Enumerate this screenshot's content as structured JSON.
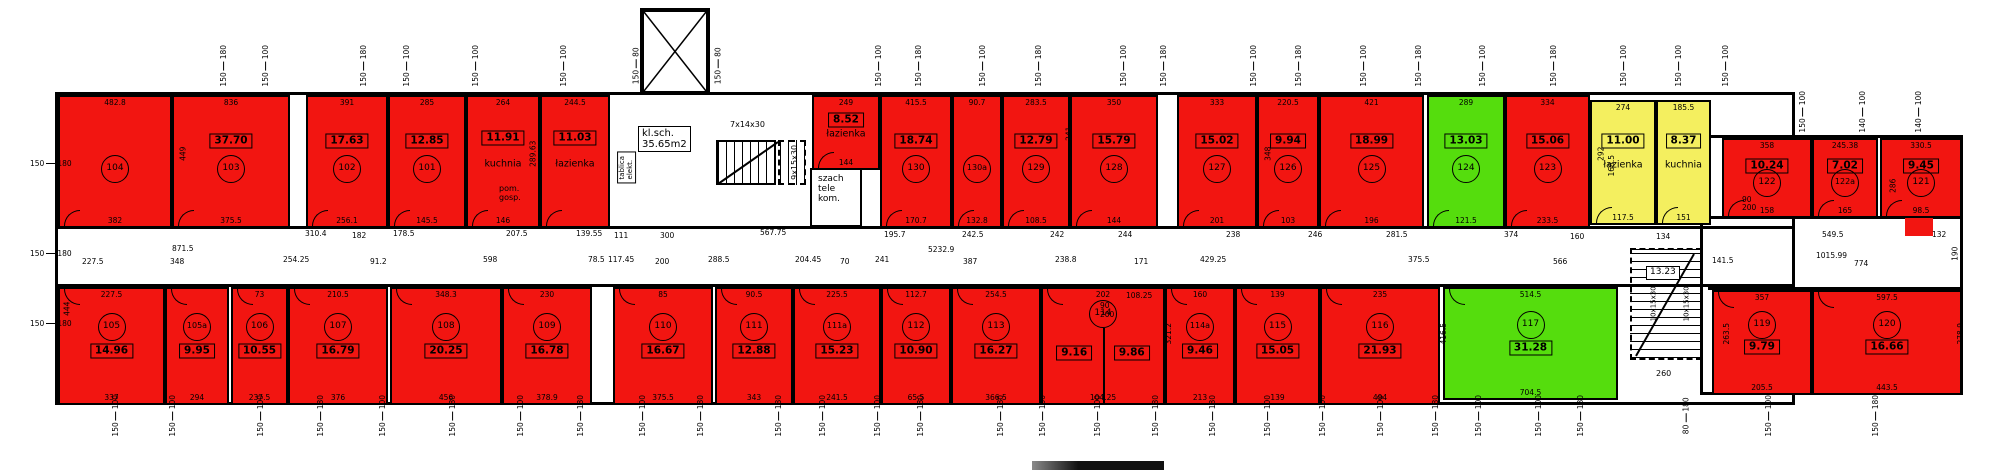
{
  "plan": {
    "colors": {
      "red": "#f21511",
      "green": "#55dd0d",
      "yellow": "#f4ef5f",
      "wall": "#000000"
    },
    "stair_hall_label": [
      "kl.sch.",
      "35.65m2"
    ],
    "rooms": [
      {
        "x": 58,
        "y": 95,
        "w": 114,
        "h": 133,
        "c": "red",
        "row": "top",
        "id": "104",
        "dimTop": "482.8",
        "dimBot": "382"
      },
      {
        "x": 172,
        "y": 95,
        "w": 118,
        "h": 133,
        "c": "red",
        "row": "top",
        "id": "103",
        "area": "37.70",
        "dimTop": "836",
        "dimBot": "375.5"
      },
      {
        "x": 306,
        "y": 95,
        "w": 82,
        "h": 133,
        "c": "red",
        "row": "top",
        "id": "102",
        "area": "17.63",
        "dimTop": "391",
        "dimBot": "256.1"
      },
      {
        "x": 388,
        "y": 95,
        "w": 78,
        "h": 133,
        "c": "red",
        "row": "top",
        "id": "101",
        "area": "12.85",
        "dimTop": "285",
        "dimBot": "145.5"
      },
      {
        "x": 466,
        "y": 95,
        "w": 74,
        "h": 133,
        "c": "red",
        "row": "top",
        "name": "kuchnia",
        "area": "11.91",
        "dimTop": "264",
        "dimBot": "146"
      },
      {
        "x": 540,
        "y": 95,
        "w": 70,
        "h": 133,
        "c": "red",
        "row": "top",
        "name": "łazienka",
        "area": "11.03",
        "dimTop": "244.5"
      },
      {
        "x": 812,
        "y": 95,
        "w": 68,
        "h": 75,
        "c": "red",
        "row": "top",
        "name": "łazienka",
        "area": "8.52",
        "dimTop": "249",
        "dimBot": "144"
      },
      {
        "x": 880,
        "y": 95,
        "w": 72,
        "h": 133,
        "c": "red",
        "row": "top",
        "id": "130",
        "area": "18.74",
        "dimTop": "415.5",
        "dimBot": "170.7"
      },
      {
        "x": 952,
        "y": 95,
        "w": 50,
        "h": 133,
        "c": "red",
        "row": "top",
        "id": "130a",
        "dimTop": "90.7",
        "dimBot": "132.8"
      },
      {
        "x": 1002,
        "y": 95,
        "w": 68,
        "h": 133,
        "c": "red",
        "row": "top",
        "id": "129",
        "area": "12.79",
        "dimTop": "283.5",
        "dimBot": "108.5"
      },
      {
        "x": 1070,
        "y": 95,
        "w": 88,
        "h": 133,
        "c": "red",
        "row": "top",
        "id": "128",
        "area": "15.79",
        "dimTop": "350",
        "dimBot": "144"
      },
      {
        "x": 1177,
        "y": 95,
        "w": 80,
        "h": 133,
        "c": "red",
        "row": "top",
        "id": "127",
        "area": "15.02",
        "dimTop": "333",
        "dimBot": "201"
      },
      {
        "x": 1257,
        "y": 95,
        "w": 62,
        "h": 133,
        "c": "red",
        "row": "top",
        "id": "126",
        "area": "9.94",
        "dimTop": "220.5",
        "dimBot": "103"
      },
      {
        "x": 1319,
        "y": 95,
        "w": 105,
        "h": 133,
        "c": "red",
        "row": "top",
        "id": "125",
        "area": "18.99",
        "dimTop": "421",
        "dimBot": "196"
      },
      {
        "x": 1427,
        "y": 95,
        "w": 78,
        "h": 133,
        "c": "green",
        "row": "top",
        "id": "124",
        "area": "13.03",
        "dimTop": "289",
        "dimBot": "121.5"
      },
      {
        "x": 1505,
        "y": 95,
        "w": 85,
        "h": 133,
        "c": "red",
        "row": "top",
        "id": "123",
        "area": "15.06",
        "dimTop": "334",
        "dimBot": "233.5"
      },
      {
        "x": 1590,
        "y": 100,
        "w": 66,
        "h": 125,
        "c": "yellow",
        "row": "top",
        "name": "łazienka",
        "area": "11.00",
        "dimTop": "274",
        "dimBot": "117.5"
      },
      {
        "x": 1656,
        "y": 100,
        "w": 55,
        "h": 125,
        "c": "yellow",
        "row": "top",
        "name": "kuchnia",
        "area": "8.37",
        "dimTop": "185.5",
        "dimBot": "151"
      },
      {
        "x": 1722,
        "y": 138,
        "w": 90,
        "h": 80,
        "c": "red",
        "row": "top",
        "id": "122",
        "area": "10.24",
        "dimTop": "358",
        "dimBot": "158"
      },
      {
        "x": 1812,
        "y": 138,
        "w": 66,
        "h": 80,
        "c": "red",
        "row": "top",
        "id": "122a",
        "area": "7.02",
        "dimTop": "245.38",
        "dimBot": "165"
      },
      {
        "x": 1880,
        "y": 138,
        "w": 82,
        "h": 80,
        "c": "red",
        "row": "top",
        "id": "121",
        "area": "9.45",
        "dimTop": "330.5",
        "dimBot": "98.5"
      },
      {
        "x": 58,
        "y": 287,
        "w": 107,
        "h": 118,
        "c": "red",
        "row": "bottom",
        "id": "105",
        "area": "14.96",
        "dimTop": "227.5",
        "dimBot": "337"
      },
      {
        "x": 165,
        "y": 287,
        "w": 64,
        "h": 118,
        "c": "red",
        "row": "bottom",
        "id": "105a",
        "area": "9.95",
        "dimBot": "294"
      },
      {
        "x": 231,
        "y": 287,
        "w": 57,
        "h": 118,
        "c": "red",
        "row": "bottom",
        "id": "106",
        "area": "10.55",
        "dimTop": "73",
        "dimBot": "237.5"
      },
      {
        "x": 288,
        "y": 287,
        "w": 100,
        "h": 118,
        "c": "red",
        "row": "bottom",
        "id": "107",
        "area": "16.79",
        "dimTop": "210.5",
        "dimBot": "376"
      },
      {
        "x": 390,
        "y": 287,
        "w": 112,
        "h": 118,
        "c": "red",
        "row": "bottom",
        "id": "108",
        "area": "20.25",
        "dimTop": "348.3",
        "dimBot": "456"
      },
      {
        "x": 502,
        "y": 287,
        "w": 90,
        "h": 118,
        "c": "red",
        "row": "bottom",
        "id": "109",
        "area": "16.78",
        "dimTop": "230",
        "dimBot": "378.9"
      },
      {
        "x": 613,
        "y": 287,
        "w": 100,
        "h": 118,
        "c": "red",
        "row": "bottom",
        "id": "110",
        "area": "16.67",
        "dimTop": "85",
        "dimBot": "375.5"
      },
      {
        "x": 715,
        "y": 287,
        "w": 78,
        "h": 118,
        "c": "red",
        "row": "bottom",
        "id": "111",
        "area": "12.88",
        "dimTop": "90.5",
        "dimBot": "343"
      },
      {
        "x": 793,
        "y": 287,
        "w": 88,
        "h": 118,
        "c": "red",
        "row": "bottom",
        "id": "111a",
        "area": "15.23",
        "dimTop": "225.5",
        "dimBot": "241.5"
      },
      {
        "x": 881,
        "y": 287,
        "w": 70,
        "h": 118,
        "c": "red",
        "row": "bottom",
        "id": "112",
        "area": "10.90",
        "dimTop": "112.7",
        "dimBot": "65.5"
      },
      {
        "x": 951,
        "y": 287,
        "w": 90,
        "h": 118,
        "c": "red",
        "row": "bottom",
        "id": "113",
        "area": "16.27",
        "dimTop": "254.5",
        "dimBot": "366.5"
      },
      {
        "x": 1041,
        "y": 287,
        "w": 124,
        "h": 118,
        "c": "red",
        "row": "bottom",
        "id": "114",
        "area": "9.16",
        "area2": "9.86",
        "dimTop": "202",
        "dimBot": "104.25"
      },
      {
        "x": 1165,
        "y": 287,
        "w": 70,
        "h": 118,
        "c": "red",
        "row": "bottom",
        "id": "114a",
        "area": "9.46",
        "dimTop": "160",
        "dimBot": "213"
      },
      {
        "x": 1235,
        "y": 287,
        "w": 85,
        "h": 118,
        "c": "red",
        "row": "bottom",
        "id": "115",
        "area": "15.05",
        "dimTop": "139",
        "dimBot": "139"
      },
      {
        "x": 1320,
        "y": 287,
        "w": 120,
        "h": 118,
        "c": "red",
        "row": "bottom",
        "id": "116",
        "area": "21.93",
        "dimTop": "235",
        "dimBot": "494"
      },
      {
        "x": 1443,
        "y": 287,
        "w": 175,
        "h": 113,
        "c": "green",
        "row": "bottom",
        "id": "117",
        "area": "31.28",
        "dimTop": "514.5",
        "dimBot": "704.5"
      },
      {
        "x": 1712,
        "y": 290,
        "w": 100,
        "h": 105,
        "c": "red",
        "row": "bottom",
        "id": "119",
        "area": "9.79",
        "dimTop": "357",
        "dimBot": "205.5"
      },
      {
        "x": 1812,
        "y": 290,
        "w": 150,
        "h": 105,
        "c": "red",
        "row": "bottom",
        "id": "120",
        "area": "16.66",
        "dimTop": "597.5",
        "dimBot": "443.5"
      }
    ],
    "labels": [
      {
        "lines": [
          "kl.sch.",
          "35.65m2"
        ],
        "x": 638,
        "y": 126,
        "bx": true,
        "size": 10
      },
      {
        "lines": [
          "7x14x30"
        ],
        "x": 730,
        "y": 121,
        "size": 8
      },
      {
        "lines": [
          "9x15x30"
        ],
        "x": 778,
        "y": 158,
        "v": true,
        "size": 8
      },
      {
        "lines": [
          "tablica",
          "elekt."
        ],
        "x": 611,
        "y": 158,
        "v": true,
        "size": 7,
        "bx": true
      },
      {
        "lines": [
          "szach",
          "tele",
          "kom."
        ],
        "x": 818,
        "y": 175,
        "size": 9
      },
      {
        "lines": [
          "pom.",
          "gosp."
        ],
        "x": 499,
        "y": 185,
        "size": 8
      },
      {
        "lines": [
          "13.23"
        ],
        "x": 1646,
        "y": 266,
        "bx": true,
        "size": 9
      },
      {
        "lines": [
          "10x15x30"
        ],
        "x": 1637,
        "y": 300,
        "v": true,
        "size": 7
      },
      {
        "lines": [
          "10x15x30"
        ],
        "x": 1670,
        "y": 300,
        "v": true,
        "size": 7
      },
      {
        "lines": [
          "260"
        ],
        "x": 1656,
        "y": 370,
        "size": 8
      }
    ],
    "dims": [
      {
        "t": "871.5",
        "x": 172,
        "y": 245
      },
      {
        "t": "227.5",
        "x": 82,
        "y": 258
      },
      {
        "t": "348",
        "x": 170,
        "y": 258
      },
      {
        "t": "254.25",
        "x": 283,
        "y": 256
      },
      {
        "t": "91.2",
        "x": 370,
        "y": 258
      },
      {
        "t": "598",
        "x": 483,
        "y": 256
      },
      {
        "t": "78.5",
        "x": 588,
        "y": 256
      },
      {
        "t": "117.45",
        "x": 608,
        "y": 256
      },
      {
        "t": "200",
        "x": 655,
        "y": 258
      },
      {
        "t": "288.5",
        "x": 708,
        "y": 256
      },
      {
        "t": "204.45",
        "x": 795,
        "y": 256
      },
      {
        "t": "70",
        "x": 840,
        "y": 258
      },
      {
        "t": "241",
        "x": 875,
        "y": 256
      },
      {
        "t": "387",
        "x": 963,
        "y": 258
      },
      {
        "t": "238.8",
        "x": 1055,
        "y": 256
      },
      {
        "t": "171",
        "x": 1134,
        "y": 258
      },
      {
        "t": "429.25",
        "x": 1200,
        "y": 256
      },
      {
        "t": "375.5",
        "x": 1408,
        "y": 256
      },
      {
        "t": "566",
        "x": 1553,
        "y": 258
      },
      {
        "t": "5232.9",
        "x": 928,
        "y": 246
      },
      {
        "t": "310.4",
        "x": 305,
        "y": 230
      },
      {
        "t": "182",
        "x": 352,
        "y": 232
      },
      {
        "t": "178.5",
        "x": 393,
        "y": 230
      },
      {
        "t": "207.5",
        "x": 506,
        "y": 230
      },
      {
        "t": "139.55",
        "x": 576,
        "y": 230
      },
      {
        "t": "111",
        "x": 614,
        "y": 232
      },
      {
        "t": "300",
        "x": 660,
        "y": 232
      },
      {
        "t": "567.75",
        "x": 760,
        "y": 229
      },
      {
        "t": "195.7",
        "x": 884,
        "y": 231
      },
      {
        "t": "242.5",
        "x": 962,
        "y": 231
      },
      {
        "t": "242",
        "x": 1050,
        "y": 231
      },
      {
        "t": "244",
        "x": 1118,
        "y": 231
      },
      {
        "t": "238",
        "x": 1226,
        "y": 231
      },
      {
        "t": "246",
        "x": 1308,
        "y": 231
      },
      {
        "t": "281.5",
        "x": 1386,
        "y": 231
      },
      {
        "t": "374",
        "x": 1504,
        "y": 231
      },
      {
        "t": "160",
        "x": 1570,
        "y": 233
      },
      {
        "t": "134",
        "x": 1656,
        "y": 233
      },
      {
        "t": "549.5",
        "x": 1822,
        "y": 231
      },
      {
        "t": "132",
        "x": 1932,
        "y": 231
      },
      {
        "t": "141.5",
        "x": 1712,
        "y": 257
      },
      {
        "t": "1015.99",
        "x": 1816,
        "y": 252
      },
      {
        "t": "774",
        "x": 1854,
        "y": 260
      },
      {
        "t": "190",
        "x": 1948,
        "y": 250,
        "v": true
      },
      {
        "t": "108.25",
        "x": 1126,
        "y": 292
      },
      {
        "t": "444",
        "x": 60,
        "y": 305,
        "v": true
      },
      {
        "t": "449",
        "x": 176,
        "y": 150,
        "v": true
      },
      {
        "t": "348",
        "x": 1261,
        "y": 150,
        "v": true
      },
      {
        "t": "286",
        "x": 1886,
        "y": 182,
        "v": true
      },
      {
        "t": "292",
        "x": 1594,
        "y": 150,
        "v": true
      },
      {
        "t": "416.5",
        "x": 1433,
        "y": 330,
        "v": true
      },
      {
        "t": "321.2",
        "x": 1158,
        "y": 330,
        "v": true
      },
      {
        "t": "263.5",
        "x": 1716,
        "y": 330,
        "v": true
      },
      {
        "t": "278.9",
        "x": 1950,
        "y": 330,
        "v": true
      },
      {
        "t": "289.63",
        "x": 520,
        "y": 150,
        "v": true
      },
      {
        "t": "241",
        "x": 1062,
        "y": 130,
        "v": true
      },
      {
        "t": "168.5",
        "x": 1601,
        "y": 162,
        "v": true
      },
      {
        "t": "90",
        "x": 1742,
        "y": 196
      },
      {
        "t": "200",
        "x": 1742,
        "y": 204
      },
      {
        "t": "90",
        "x": 1100,
        "y": 302
      },
      {
        "t": "200",
        "x": 1100,
        "y": 311
      }
    ],
    "windows_top": [
      {
        "x": 203,
        "t": "180/150"
      },
      {
        "x": 245,
        "t": "100/150"
      },
      {
        "x": 343,
        "t": "180/150"
      },
      {
        "x": 386,
        "t": "100/150"
      },
      {
        "x": 455,
        "t": "100/150"
      },
      {
        "x": 543,
        "t": "100/150"
      },
      {
        "x": 618,
        "t": "80/150"
      },
      {
        "x": 700,
        "t": "80/150"
      },
      {
        "x": 858,
        "t": "100/150"
      },
      {
        "x": 898,
        "t": "180/150"
      },
      {
        "x": 962,
        "t": "100/150"
      },
      {
        "x": 1018,
        "t": "180/150"
      },
      {
        "x": 1103,
        "t": "100/150"
      },
      {
        "x": 1143,
        "t": "180/150"
      },
      {
        "x": 1233,
        "t": "100/150"
      },
      {
        "x": 1278,
        "t": "180/150"
      },
      {
        "x": 1343,
        "t": "100/150"
      },
      {
        "x": 1398,
        "t": "180/150"
      },
      {
        "x": 1462,
        "t": "100/150"
      },
      {
        "x": 1533,
        "t": "180/150"
      },
      {
        "x": 1603,
        "t": "100/150"
      },
      {
        "x": 1658,
        "t": "100/150"
      },
      {
        "x": 1705,
        "t": "100/150"
      },
      {
        "x": 1782,
        "t": "100/150",
        "y": 108
      },
      {
        "x": 1842,
        "t": "100/140",
        "y": 108
      },
      {
        "x": 1898,
        "t": "100/140",
        "y": 108
      }
    ],
    "windows_bottom": [
      {
        "x": 95,
        "t": "100/150"
      },
      {
        "x": 152,
        "t": "100/150"
      },
      {
        "x": 240,
        "t": "100/150"
      },
      {
        "x": 300,
        "t": "180/150"
      },
      {
        "x": 362,
        "t": "100/150"
      },
      {
        "x": 432,
        "t": "180/150"
      },
      {
        "x": 500,
        "t": "100/150"
      },
      {
        "x": 560,
        "t": "180/150"
      },
      {
        "x": 622,
        "t": "100/150"
      },
      {
        "x": 680,
        "t": "180/150"
      },
      {
        "x": 758,
        "t": "180/150"
      },
      {
        "x": 802,
        "t": "100/150"
      },
      {
        "x": 857,
        "t": "100/150"
      },
      {
        "x": 900,
        "t": "180/150"
      },
      {
        "x": 980,
        "t": "180/150"
      },
      {
        "x": 1022,
        "t": "100/150"
      },
      {
        "x": 1077,
        "t": "100/150"
      },
      {
        "x": 1135,
        "t": "180/150"
      },
      {
        "x": 1192,
        "t": "180/150"
      },
      {
        "x": 1247,
        "t": "100/150"
      },
      {
        "x": 1302,
        "t": "100/150"
      },
      {
        "x": 1360,
        "t": "100/150"
      },
      {
        "x": 1415,
        "t": "180/150"
      },
      {
        "x": 1458,
        "t": "100/150"
      },
      {
        "x": 1518,
        "t": "100/150"
      },
      {
        "x": 1560,
        "t": "180/150"
      },
      {
        "x": 1668,
        "t": "180/80"
      },
      {
        "x": 1748,
        "t": "100/150"
      },
      {
        "x": 1855,
        "t": "180/150"
      }
    ],
    "windows_left": [
      {
        "y": 160,
        "t": "180/150"
      },
      {
        "y": 250,
        "t": "180/150"
      },
      {
        "y": 320,
        "t": "180/150"
      }
    ]
  }
}
